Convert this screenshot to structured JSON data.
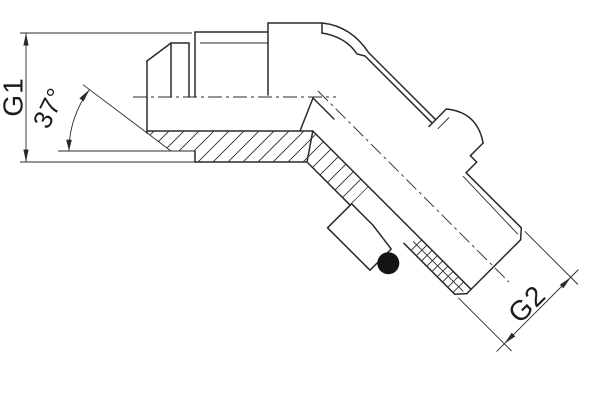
{
  "labels": {
    "g1": "G1",
    "g2": "G2",
    "angle": "37°"
  },
  "colors": {
    "line": "#2a2a2a",
    "background": "#ffffff",
    "o_ring": "#141414",
    "text": "#1c1c1c"
  }
}
